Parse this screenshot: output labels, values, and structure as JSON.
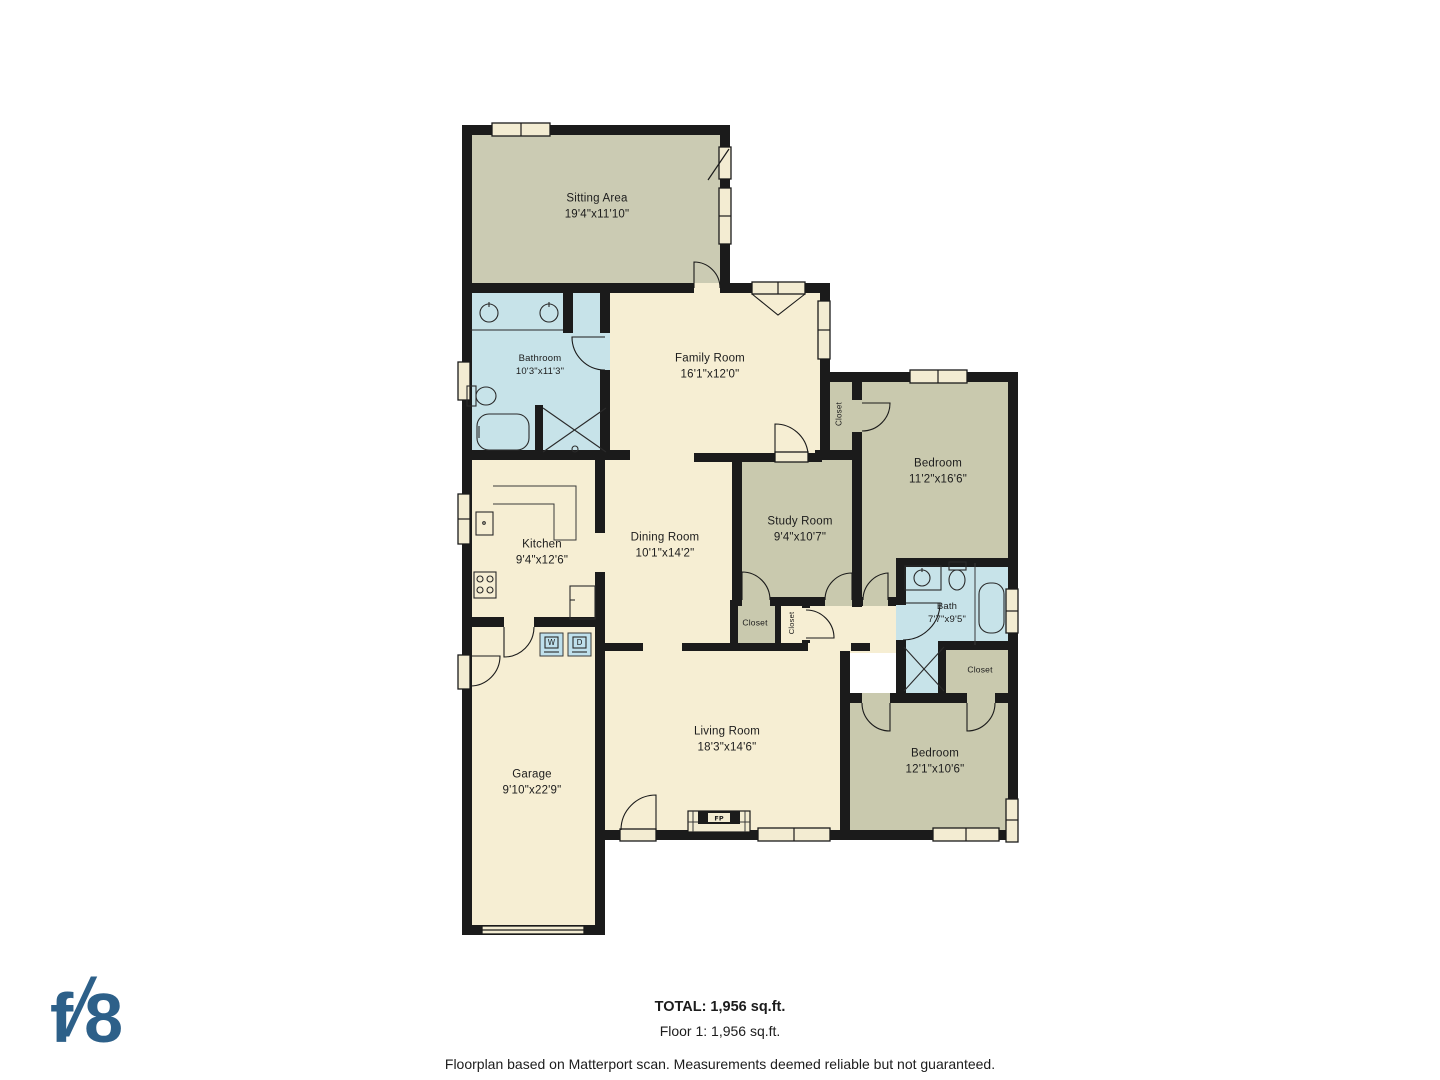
{
  "branding": {
    "logo_f": "f",
    "logo_slash": "/",
    "logo_8": "8"
  },
  "colors": {
    "wall": "#1b1b1b",
    "cream_room": "#f6eed3",
    "olive_room": "#c9c9ae",
    "sitting_room": "#cbcbb3",
    "wet_room": "#c7e3e9",
    "appliance_blue": "#bfe0ec",
    "logo_blue": "#2d6089",
    "background": "#ffffff"
  },
  "rooms": [
    {
      "id": "sitting-area",
      "name": "Sitting Area",
      "dims": "19'4\"x11'10\""
    },
    {
      "id": "bathroom",
      "name": "Bathroom",
      "dims": "10'3\"x11'3\""
    },
    {
      "id": "family-room",
      "name": "Family Room",
      "dims": "16'1\"x12'0\""
    },
    {
      "id": "closet-a",
      "name": "Closet",
      "dims": ""
    },
    {
      "id": "bedroom-1",
      "name": "Bedroom",
      "dims": "11'2\"x16'6\""
    },
    {
      "id": "kitchen",
      "name": "Kitchen",
      "dims": "9'4\"x12'6\""
    },
    {
      "id": "dining-room",
      "name": "Dining Room",
      "dims": "10'1\"x14'2\""
    },
    {
      "id": "study-room",
      "name": "Study Room",
      "dims": "9'4\"x10'7\""
    },
    {
      "id": "closet-b",
      "name": "Closet",
      "dims": ""
    },
    {
      "id": "closet-c",
      "name": "Closet",
      "dims": ""
    },
    {
      "id": "bath",
      "name": "Bath",
      "dims": "7'7\"x9'5\""
    },
    {
      "id": "closet-d",
      "name": "Closet",
      "dims": ""
    },
    {
      "id": "living-room",
      "name": "Living Room",
      "dims": "18'3\"x14'6\""
    },
    {
      "id": "garage",
      "name": "Garage",
      "dims": "9'10\"x22'9\""
    },
    {
      "id": "bedroom-2",
      "name": "Bedroom",
      "dims": "12'1\"x10'6\""
    }
  ],
  "appliances": {
    "washer": "W",
    "dryer": "D",
    "fireplace": "FP"
  },
  "footer": {
    "total": "TOTAL: 1,956 sq.ft.",
    "floor": "Floor 1: 1,956 sq.ft.",
    "disclaimer": "Floorplan based on Matterport scan. Measurements deemed reliable but not guaranteed."
  }
}
